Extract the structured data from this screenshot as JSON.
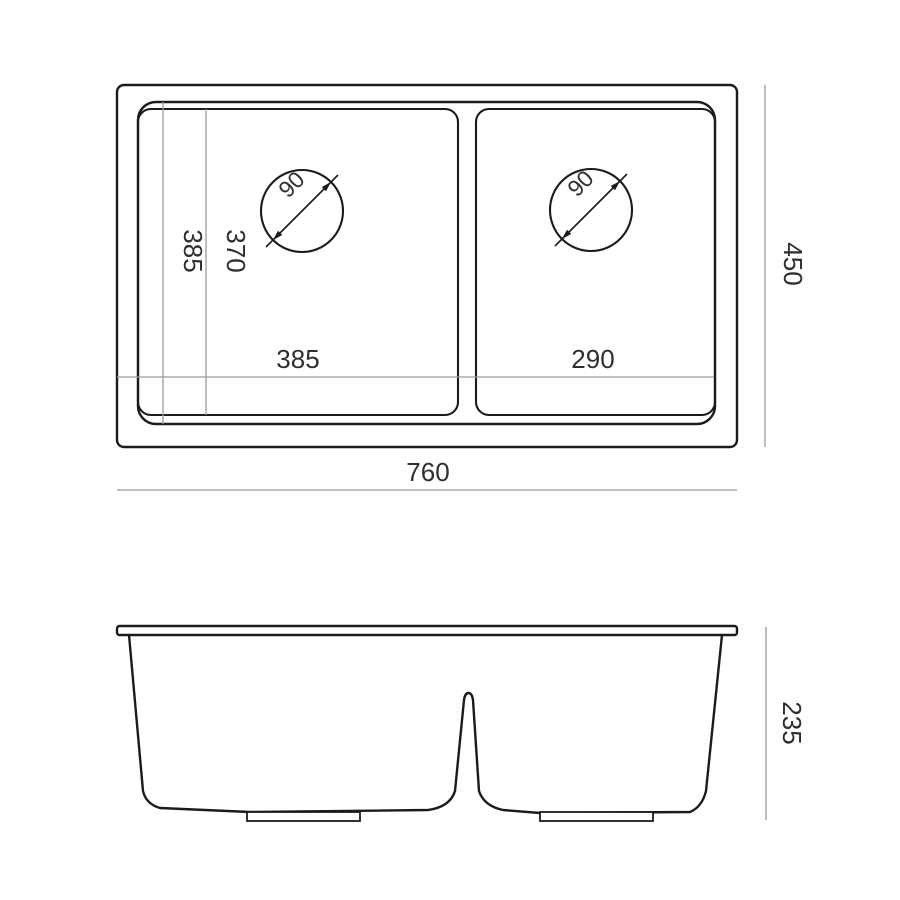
{
  "drawing": {
    "type": "sink-specification-diagram",
    "colors": {
      "background": "#ffffff",
      "outline": "#1b1b1b",
      "dimension_line": "#9b9b9b",
      "text": "#2e2e2e"
    },
    "top_view": {
      "overall_width_label": "760",
      "overall_depth_label": "450",
      "left_bowl_width_label": "385",
      "right_bowl_width_label": "290",
      "left_bowl_depth_label": "385",
      "inner_bowl_depth_label": "370",
      "left_drain_diameter_label": "90",
      "right_drain_diameter_label": "90"
    },
    "front_view": {
      "height_label": "235"
    }
  }
}
